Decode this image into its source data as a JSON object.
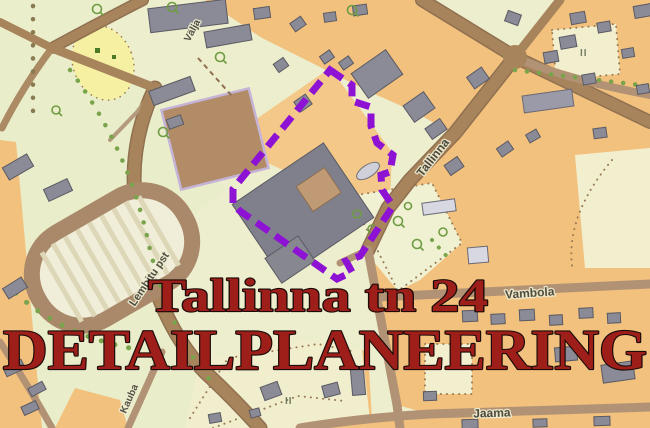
{
  "title_overlay": {
    "line1": "Tallinna tn 24",
    "line2": "DETAILPLANEERING",
    "color": "#9e1f1a"
  },
  "streets": {
    "valja": "Välja",
    "tallinna": "Tallinna",
    "lembitu": "Lembitu pst",
    "kauba": "Kauba",
    "vambola": "Vambola",
    "jaama": "Jaama"
  },
  "map": {
    "floor_mark": "II",
    "colors": {
      "boundary_purple": "#8d12d4",
      "block_orange": "#f3c17e",
      "parkland_green": "#e9edca",
      "base_cream": "#edeecd",
      "parcel_cream": "#f2efcf",
      "road_brown": "#a8845c",
      "building_gray": "#8b8b97",
      "field_brown": "#b28c66",
      "meadow_yellow": "#f6f0a3",
      "title_red": "#9e1f1a"
    }
  }
}
